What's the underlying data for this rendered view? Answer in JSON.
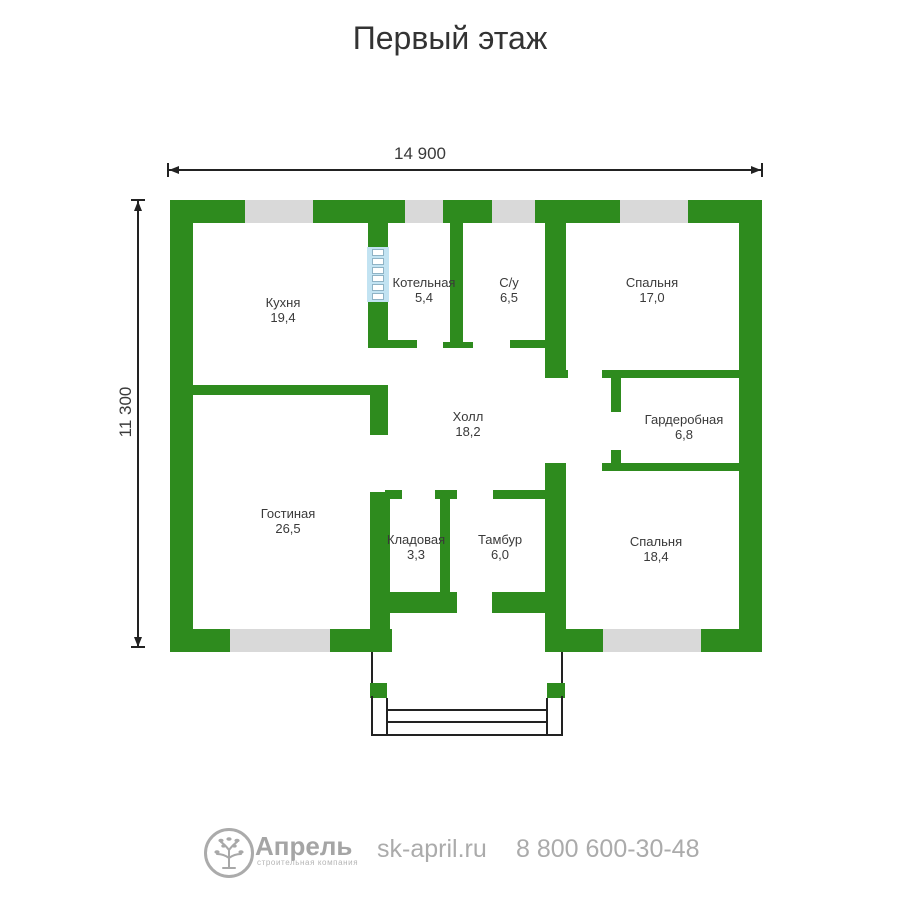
{
  "title": "Первый этаж",
  "dimensions": {
    "width_label": "14 900",
    "height_label": "11 300"
  },
  "rooms": {
    "kitchen": {
      "name": "Кухня",
      "area": "19,4"
    },
    "boiler": {
      "name": "Котельная",
      "area": "5,4"
    },
    "bathroom": {
      "name": "С/у",
      "area": "6,5"
    },
    "bedroom1": {
      "name": "Спальня",
      "area": "17,0"
    },
    "hall": {
      "name": "Холл",
      "area": "18,2"
    },
    "wardrobe": {
      "name": "Гардеробная",
      "area": "6,8"
    },
    "living": {
      "name": "Гостиная",
      "area": "26,5"
    },
    "storage": {
      "name": "Кладовая",
      "area": "3,3"
    },
    "vestibule": {
      "name": "Тамбур",
      "area": "6,0"
    },
    "bedroom2": {
      "name": "Спальня",
      "area": "18,4"
    }
  },
  "footer": {
    "brand": "Апрель",
    "brand_subtitle": "строительная компания",
    "website": "sk-april.ru",
    "phone": "8 800 600-30-48"
  },
  "colors": {
    "wall-green": "#2e8b1e",
    "window-gray": "#d9d9d9",
    "chimney-blue": "#c2e3f2",
    "text-dark": "#3a3a3a",
    "footer-gray": "#ababab",
    "line-dark": "#222222"
  }
}
